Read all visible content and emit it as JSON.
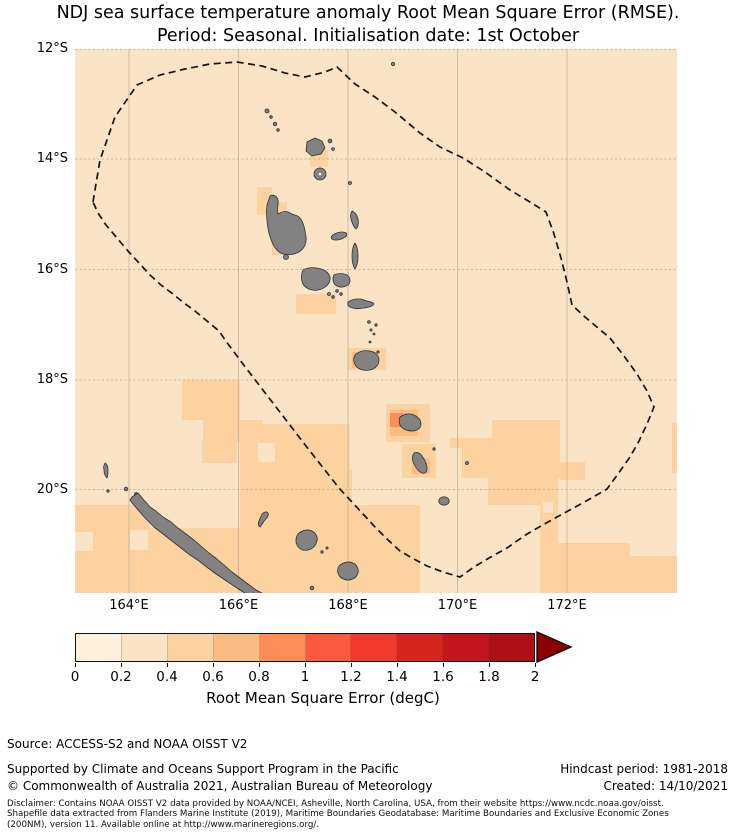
{
  "figure": {
    "title_line1": "NDJ sea surface temperature anomaly Root Mean Square Error (RMSE).",
    "title_line2": "Period: Seasonal. Initialisation date: 1st October"
  },
  "axes": {
    "lat_ticks": [
      "12°S",
      "14°S",
      "16°S",
      "18°S",
      "20°S"
    ],
    "lon_ticks": [
      "164°E",
      "166°E",
      "168°E",
      "170°E",
      "172°E"
    ]
  },
  "colorbar": {
    "label": "Root Mean Square Error (degC)",
    "tick_labels": [
      "0",
      "0.2",
      "0.4",
      "0.6",
      "0.8",
      "1",
      "1.2",
      "1.4",
      "1.6",
      "1.8",
      "2"
    ],
    "segment_colors": [
      "#fdf0dd",
      "#fbe3c6",
      "#fcd3a0",
      "#fdbb84",
      "#fc8d59",
      "#f9593f",
      "#f03b2c",
      "#d6251f",
      "#c1161b",
      "#ad1015"
    ],
    "extend_color": "#8b0000"
  },
  "footer": {
    "source": "Source: ACCESS-S2 and NOAA OISST V2",
    "supported": "Supported by Climate and Oceans Support Program in the Pacific",
    "copyright": "© Commonwealth of Australia 2021, Australian Bureau of Meteorology",
    "hindcast": "Hindcast period: 1981-2018",
    "created": "Created: 14/10/2021",
    "disclaimer_line1": "Disclaimer: Contains NOAA OISST V2 data provided by NOAA/NCEI, Asheville, North Carolina, USA, from their website https://www.ncdc.noaa.gov/oisst.",
    "disclaimer_line2": "Shapefile data extracted from Flanders Marine Institute (2019), Maritime Boundaries Geodatabase: Maritime Boundaries and Exclusive Economic Zones",
    "disclaimer_line3": "(200NM), version 11. Available online at http://www.marineregions.org/."
  },
  "chart_data": {
    "type": "heatmap",
    "title": "NDJ sea surface temperature anomaly Root Mean Square Error (RMSE). Period: Seasonal. Initialisation date: 1st October",
    "x_ticks": [
      "164°E",
      "166°E",
      "168°E",
      "170°E",
      "172°E"
    ],
    "y_ticks": [
      "12°S",
      "14°S",
      "16°S",
      "18°S",
      "20°S"
    ],
    "lon_range_deg_east": [
      163,
      174
    ],
    "lat_range_deg_south": [
      12,
      22
    ],
    "grid": true,
    "colorbar": {
      "label": "Root Mean Square Error (degC)",
      "range": [
        0,
        2
      ],
      "step": 0.2,
      "extend": "max",
      "colors": [
        "#fdf0dd",
        "#fbe3c6",
        "#fcd3a0",
        "#fdbb84",
        "#fc8d59",
        "#f9593f",
        "#f03b2c",
        "#d6251f",
        "#c1161b",
        "#ad1015",
        "#8b0000"
      ]
    },
    "map_features": [
      "Vanuatu island chain (grey land)",
      "New Caledonia and Loyalty Islands (grey land)",
      "dashed exclusive economic zone boundary polygon"
    ],
    "values_summary": [
      {
        "rmse_range": "0.2-0.4",
        "coverage": "most of the ocean domain"
      },
      {
        "rmse_range": "0.4-0.6",
        "coverage": "broad patches southwest near New Caledonia, around the southern Vanuatu islands, a large block near 169-171E / 19-20S and the southeast corner"
      },
      {
        "rmse_range": "0.6-0.8",
        "coverage": "cells adjacent to Efate, Erromango and Tanna islands"
      },
      {
        "rmse_range": "0.8-1.0",
        "coverage": "single cell immediately west of Erromango"
      }
    ]
  }
}
